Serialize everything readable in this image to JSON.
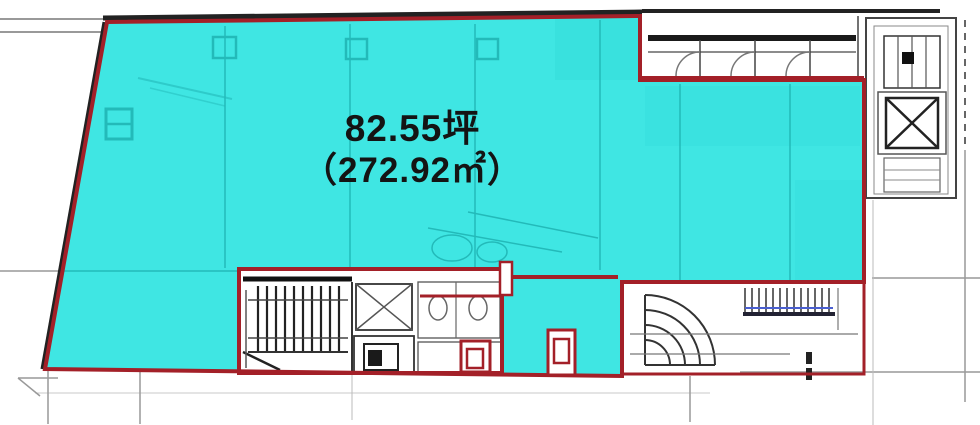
{
  "floorplan": {
    "area_tsubo": "82.55坪",
    "area_sqm": "（272.92㎡）",
    "highlight_color": "#3FE6E3",
    "outline_color": "#A32028",
    "wall_color": "#222222",
    "accent_blue": "#4A5FD0",
    "symbols": {
      "stairs": "stairs-symbol",
      "elevator": "elevator-symbol",
      "spiral_stairs": "spiral-stair-symbol",
      "toilet": "toilet-symbol"
    }
  }
}
